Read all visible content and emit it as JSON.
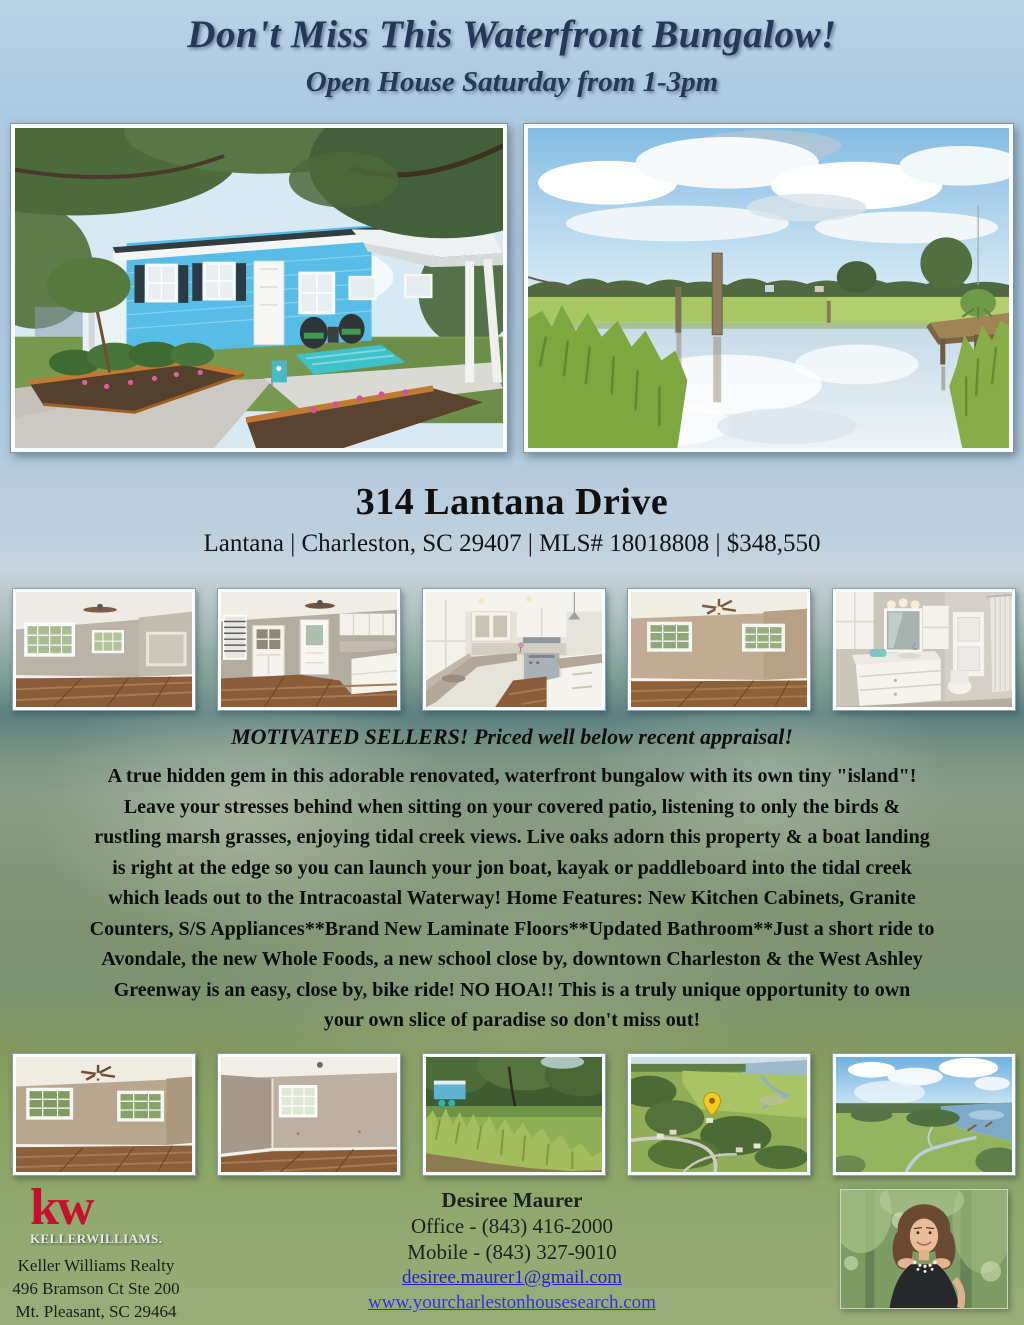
{
  "listing": {
    "title": "Don't Miss This Waterfront Bungalow!",
    "subtitle": "Open House Saturday from 1-3pm",
    "address": "314 Lantana Drive",
    "info_line": "Lantana | Charleston, SC 29407 | MLS# 18018808 | $348,550",
    "headline": "MOTIVATED SELLERS! Priced well below recent appraisal!",
    "description_lines": [
      "A true hidden gem in this adorable renovated, waterfront bungalow with its own tiny \"island\"!",
      "Leave your stresses behind when sitting on your covered patio, listening to only the birds &",
      "rustling marsh grasses, enjoying tidal creek views. Live oaks adorn this property & a boat landing",
      "is right at the edge so you can launch your jon boat, kayak or paddleboard into the tidal creek",
      "which leads out to the Intracoastal Waterway! Home Features: New Kitchen Cabinets, Granite",
      "Counters, S/S Appliances**Brand New Laminate Floors**Updated Bathroom**Just a short ride to",
      "Avondale, the new Whole Foods, a new school close by, downtown Charleston & the West Ashley",
      "Greenway is an easy, close by, bike ride! NO HOA!! This is a truly unique opportunity to own",
      "your own slice of paradise so don't miss out!"
    ]
  },
  "photos": {
    "main_left_alt": "Blue waterfront bungalow exterior with covered patio and landscaped beds",
    "main_right_alt": "Tidal creek and marsh view with wooden dock",
    "row1": [
      "Living room with laminate floors",
      "Dining area with built-in hutch and door",
      "Kitchen with white cabinets and granite counters",
      "Bedroom with ceiling fan and two windows",
      "Bathroom with white vanity and mirror"
    ],
    "row2": [
      "Bedroom with ceiling fan and two windows",
      "Bedroom corner with single window",
      "Backyard marsh grass and live oak view",
      "Aerial neighborhood view with location pin",
      "Aerial marsh and river view"
    ],
    "agent_headshot_alt": "Agent headshot portrait"
  },
  "brokerage": {
    "logo_kw": "kw",
    "logo_wordmark": "KELLERWILLIAMS.",
    "name": "Keller Williams Realty",
    "address_line1": "496 Bramson Ct Ste 200",
    "address_line2": "Mt. Pleasant, SC 29464"
  },
  "agent": {
    "name": "Desiree Maurer",
    "office_phone": "Office - (843) 416-2000",
    "mobile_phone": "Mobile - (843) 327-9010",
    "email": "desiree.maurer1@gmail.com",
    "website": "www.yourcharlestonhousesearch.com"
  },
  "colors": {
    "title_navy": "#24395a",
    "kw_red": "#c40f2e",
    "email_link": "#2222cc",
    "website_link": "#2b35ea"
  }
}
